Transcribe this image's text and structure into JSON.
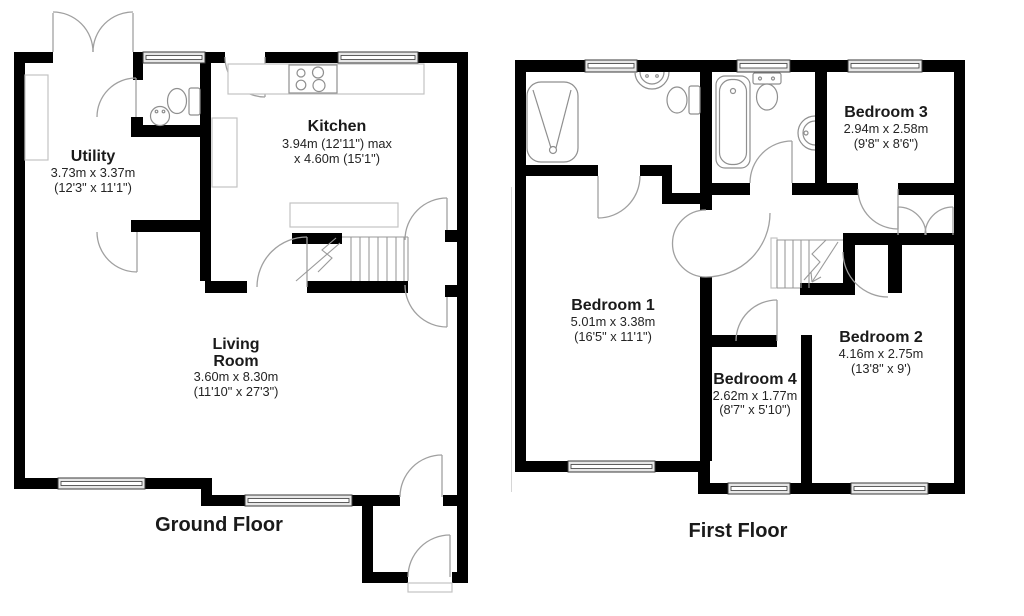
{
  "floors": [
    {
      "label": "Ground Floor",
      "rooms": [
        {
          "name": "Utility",
          "size_metric": "3.73m x 3.37m",
          "size_imperial": "(12'3\" x 11'1\")"
        },
        {
          "name": "Kitchen",
          "size_metric": "3.94m (12'11\") max",
          "size_imperial": "x 4.60m (15'1\")"
        },
        {
          "name_line1": "Living",
          "name_line2": "Room",
          "size_metric": "3.60m x 8.30m",
          "size_imperial": "(11'10\" x 27'3\")"
        }
      ],
      "fixture_icons": [
        "french-doors",
        "window",
        "toilet",
        "hand-basin",
        "worktop",
        "hob",
        "staircase",
        "door-arc",
        "front-door-step"
      ]
    },
    {
      "label": "First Floor",
      "rooms": [
        {
          "name": "Bedroom 1",
          "size_metric": "5.01m x 3.38m",
          "size_imperial": "(16'5\" x 11'1\")"
        },
        {
          "name": "Bedroom 2",
          "size_metric": "4.16m x 2.75m",
          "size_imperial": "(13'8\" x 9')"
        },
        {
          "name": "Bedroom 3",
          "size_metric": "2.94m x 2.58m",
          "size_imperial": "(9'8\" x 8'6\")"
        },
        {
          "name": "Bedroom 4",
          "size_metric": "2.62m x 1.77m",
          "size_imperial": "(8'7\" x 5'10\")"
        }
      ],
      "fixture_icons": [
        "shower",
        "basin",
        "toilet",
        "bath",
        "staircase",
        "cupboard-doors",
        "window",
        "door-arc"
      ]
    }
  ],
  "colors": {
    "wall": "#000000",
    "door_line": "#a0a0a0",
    "window_fill": "#e7e7e7",
    "text": "#1a1a1a",
    "background": "#ffffff"
  }
}
